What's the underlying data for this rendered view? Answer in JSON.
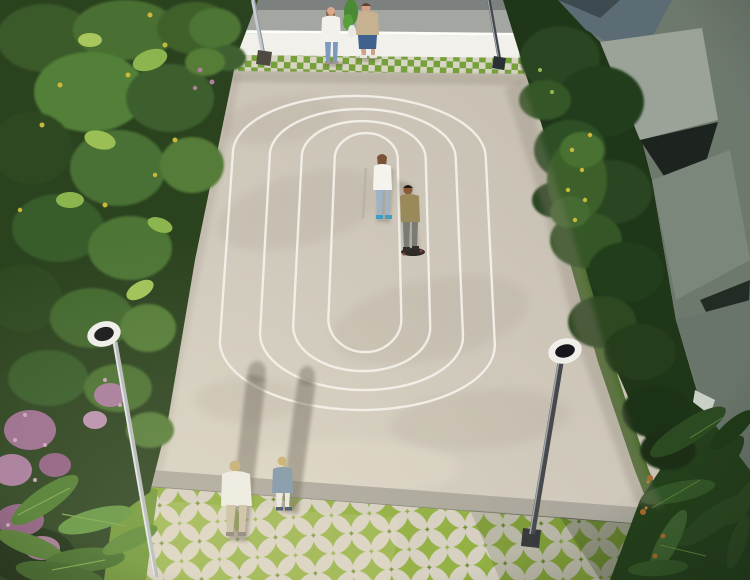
{
  "scene": {
    "description": "Aerial 3D architectural rendering of a residential courtyard: a light concrete plaza marked with four concentric white oval track lines, bordered by dense planting on the left, a dark clipped hedge and angular gray apartment facades on the right, a white wall with a green-and-white checker tile strip at the top, and a grass-and-stone circular paver plaza at the bottom. Two ring-headed lamp posts stand at left and right. Six people: a couple at the top holding a green sapling, a woman and a young skateboarder at the center of the track, and a man and a woman walking at the bottom casting long shadows.",
    "objects": {
      "people_count": 6,
      "lamp_count": 2,
      "track_line_count": 4,
      "buildings_count": 2
    },
    "people": [
      {
        "id": "woman-top",
        "clothing": "white blouse, light blue jeans"
      },
      {
        "id": "man-top",
        "clothing": "beige t-shirt, blue denim shorts, holding green sapling"
      },
      {
        "id": "woman-center",
        "clothing": "white tank top, light jeans, blue sneakers"
      },
      {
        "id": "skateboarder-center",
        "clothing": "olive t-shirt, gray pants, dark skateboard"
      },
      {
        "id": "man-bottom",
        "clothing": "white shirt, beige trousers"
      },
      {
        "id": "woman-bottom",
        "clothing": "steel-blue jacket, white pants, blonde ponytail"
      }
    ],
    "palette": {
      "concrete_light": "#d7d1c4",
      "concrete_dark": "#c5beb0",
      "track_line": "#f3f1ea",
      "wall_white": "#f1f0ea",
      "wall_highlight": "#fdfdf9",
      "terrace_gray": "#a3a6a1",
      "terrace_edge": "#7c807e",
      "checker_green": "#76a03a",
      "checker_stone": "#d8d5c5",
      "curb": "#aba79c",
      "paver_grass": "#8fae3e",
      "paver_stone": "#d5cfc1",
      "grass_strip": "#6d9140",
      "grass_strip_right": "#4c6e2f",
      "foliage_base": "#2b421f",
      "hedge_base": "#1f3618",
      "building_left": "#95a095",
      "building_right": "#6e796e",
      "glass_blue": "#5b6c75",
      "lamp_ring": "#efeee9",
      "lamp_core": "#16171a",
      "flower_pink": "#a77b9b",
      "flower_yellow": "#c9b83b",
      "flower_orange": "#b06a2a",
      "shadow": "#6e675c"
    }
  }
}
